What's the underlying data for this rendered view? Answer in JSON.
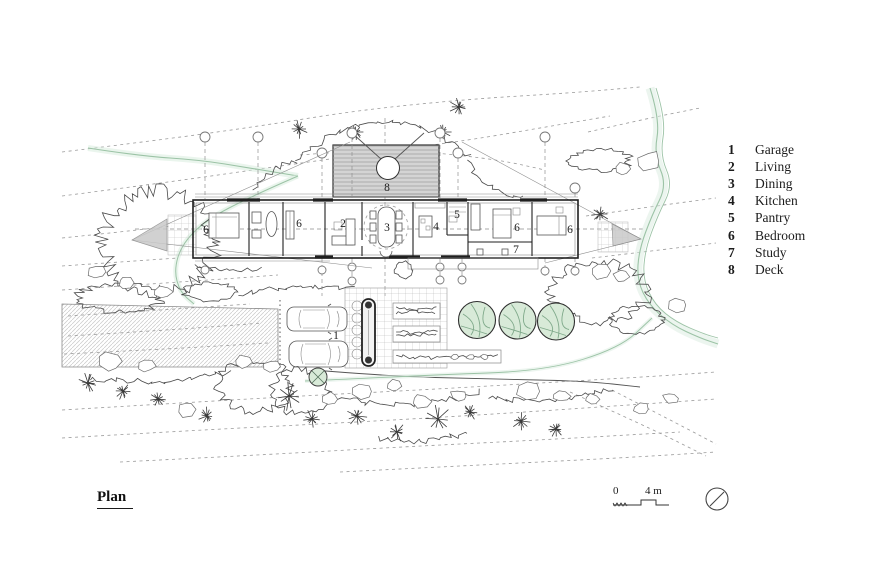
{
  "title": {
    "label": "Plan"
  },
  "legend": {
    "items": [
      {
        "num": "1",
        "label": "Garage"
      },
      {
        "num": "2",
        "label": "Living"
      },
      {
        "num": "3",
        "label": "Dining"
      },
      {
        "num": "4",
        "label": "Kitchen"
      },
      {
        "num": "5",
        "label": "Pantry"
      },
      {
        "num": "6",
        "label": "Bedroom"
      },
      {
        "num": "7",
        "label": "Study"
      },
      {
        "num": "8",
        "label": "Deck"
      }
    ]
  },
  "room_markers": {
    "garage": "1",
    "living": "2",
    "dining": "3",
    "kitchen": "4",
    "pantry": "5",
    "bedroom": "6",
    "study": "7",
    "deck": "8"
  },
  "scale_bar": {
    "start": "0",
    "end": "4 m"
  },
  "colors": {
    "tree_fill": "#d8ead8",
    "tree_line": "#7fa98a",
    "stream": "#9cc3a6",
    "stream_soft": "#d9ecdf",
    "deck_fill": "#d4d4d4",
    "triangle": "#c9c9c9"
  }
}
